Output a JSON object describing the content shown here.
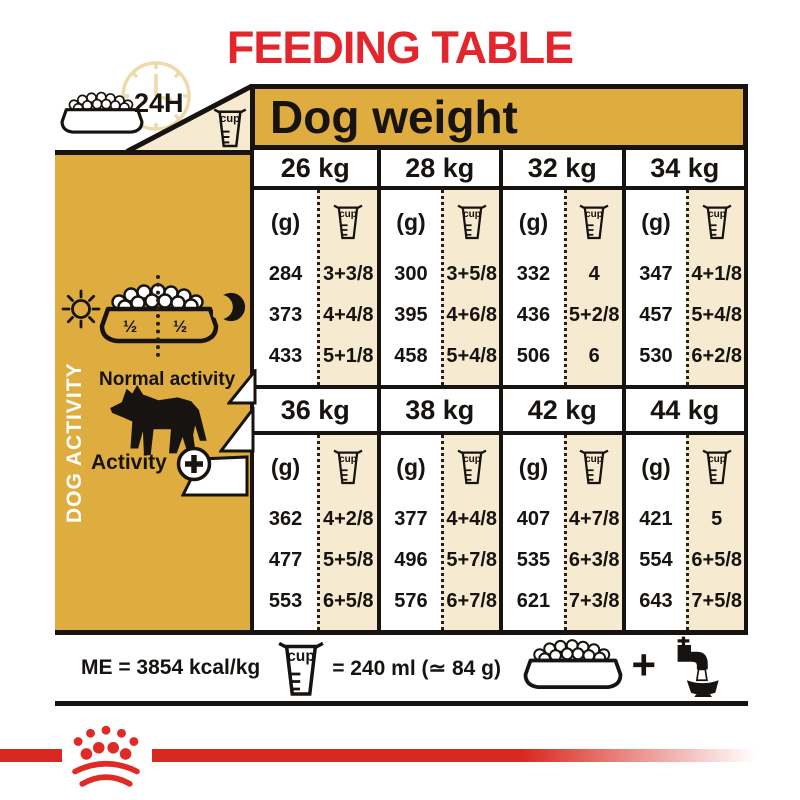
{
  "title": "FEEDING TABLE",
  "header": {
    "duration_label": "24H",
    "dog_weight_label": "Dog weight"
  },
  "sidebar": {
    "vertical_label": "DOG ACTIVITY",
    "half_left": "½",
    "half_right": "½",
    "normal_activity_label": "Normal activity",
    "activity_plus_label": "Activity"
  },
  "table": {
    "gram_unit_label": "(g)",
    "cup_unit_label": "cup",
    "blocks": [
      {
        "columns": [
          {
            "weight": "26 kg",
            "rows": [
              {
                "g": "284",
                "cups": "3+3/8"
              },
              {
                "g": "373",
                "cups": "4+4/8"
              },
              {
                "g": "433",
                "cups": "5+1/8"
              }
            ]
          },
          {
            "weight": "28 kg",
            "rows": [
              {
                "g": "300",
                "cups": "3+5/8"
              },
              {
                "g": "395",
                "cups": "4+6/8"
              },
              {
                "g": "458",
                "cups": "5+4/8"
              }
            ]
          },
          {
            "weight": "32 kg",
            "rows": [
              {
                "g": "332",
                "cups": "4"
              },
              {
                "g": "436",
                "cups": "5+2/8"
              },
              {
                "g": "506",
                "cups": "6"
              }
            ]
          },
          {
            "weight": "34 kg",
            "rows": [
              {
                "g": "347",
                "cups": "4+1/8"
              },
              {
                "g": "457",
                "cups": "5+4/8"
              },
              {
                "g": "530",
                "cups": "6+2/8"
              }
            ]
          }
        ]
      },
      {
        "columns": [
          {
            "weight": "36 kg",
            "rows": [
              {
                "g": "362",
                "cups": "4+2/8"
              },
              {
                "g": "477",
                "cups": "5+5/8"
              },
              {
                "g": "553",
                "cups": "6+5/8"
              }
            ]
          },
          {
            "weight": "38 kg",
            "rows": [
              {
                "g": "377",
                "cups": "4+4/8"
              },
              {
                "g": "496",
                "cups": "5+7/8"
              },
              {
                "g": "576",
                "cups": "6+7/8"
              }
            ]
          },
          {
            "weight": "42 kg",
            "rows": [
              {
                "g": "407",
                "cups": "4+7/8"
              },
              {
                "g": "535",
                "cups": "6+3/8"
              },
              {
                "g": "621",
                "cups": "7+3/8"
              }
            ]
          },
          {
            "weight": "44 kg",
            "rows": [
              {
                "g": "421",
                "cups": "5"
              },
              {
                "g": "554",
                "cups": "6+5/8"
              },
              {
                "g": "643",
                "cups": "7+5/8"
              }
            ]
          }
        ]
      }
    ]
  },
  "footer": {
    "me_label": "ME = 3854 kcal/kg",
    "cup_equiv_label": "= 240 ml (≃ 84 g)",
    "plus_label": "+"
  },
  "colors": {
    "gold": "#DFAC40",
    "cream": "#F6EAD0",
    "red": "#E2262B",
    "stripe_red": "#D9281F",
    "ink": "#161310"
  }
}
